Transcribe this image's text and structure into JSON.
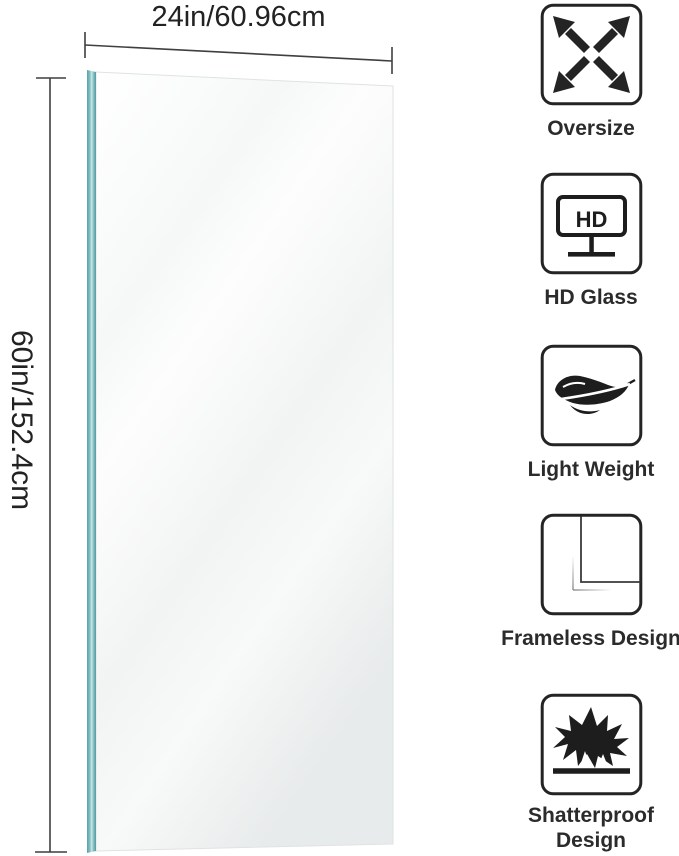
{
  "page": {
    "type": "product-infographic",
    "background": "#ffffff"
  },
  "mirror": {
    "width_label": "24in/60.96cm",
    "height_label": "60in/152.4cm",
    "edge_color": "#5fa7ac",
    "face_top_color": "#ffffff",
    "face_bottom_color": "#e9ebeb",
    "dimension_line_color": "#3f3f3f"
  },
  "features": [
    {
      "icon": "oversize-arrows-icon",
      "label": "Oversize"
    },
    {
      "icon": "hd-monitor-icon",
      "label": "HD Glass",
      "monitor_text": "HD"
    },
    {
      "icon": "feather-icon",
      "label": "Light Weight"
    },
    {
      "icon": "frameless-corner-icon",
      "label": "Frameless Design"
    },
    {
      "icon": "shatterproof-burst-icon",
      "label": "Shatterproof Design"
    }
  ]
}
